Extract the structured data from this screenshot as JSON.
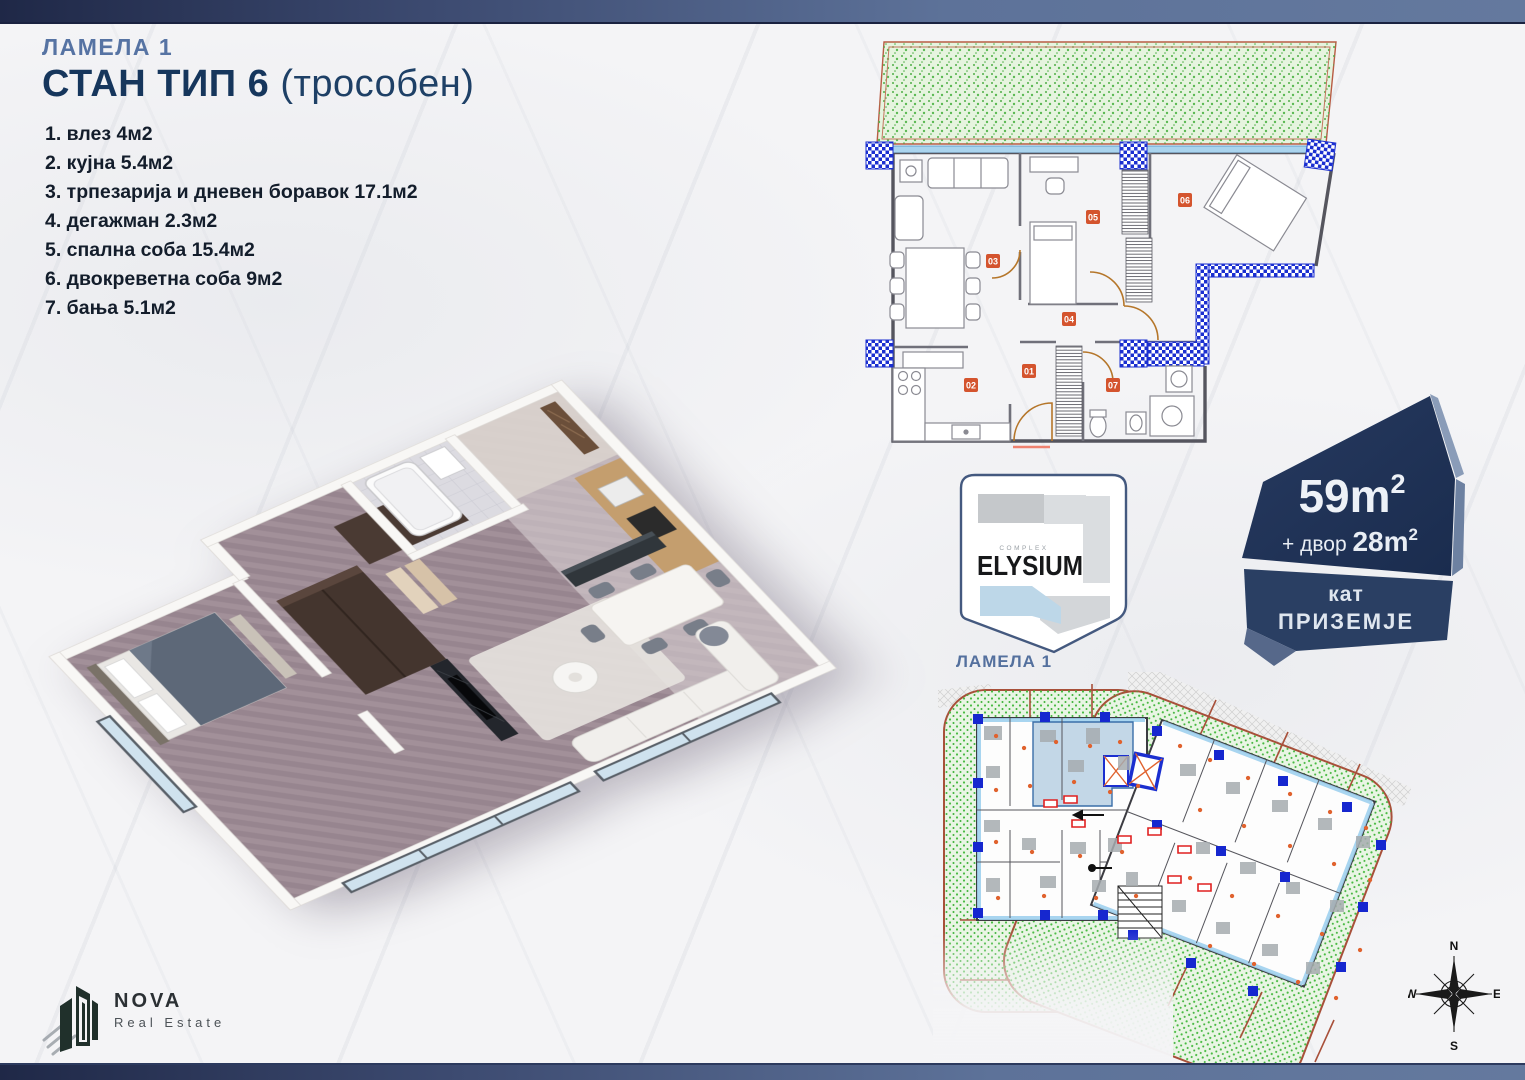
{
  "title": {
    "lamela": "ЛАМЕЛА 1",
    "main": "СТАН ТИП 6",
    "sub": "(трособен)"
  },
  "rooms": [
    "1. влез 4м2",
    "2. кујна 5.4м2",
    "3. трпезарија и дневен боравок 17.1м2",
    "4. дегажман 2.3м2",
    "5. спална соба 15.4м2",
    "6. двокреветна соба 9м2",
    "7. бања 5.1м2"
  ],
  "plan2d": {
    "labels": [
      "01",
      "02",
      "03",
      "04",
      "05",
      "06",
      "07"
    ]
  },
  "elysium": {
    "complex_label": "COMPLEX",
    "brand": "ELYSIUM",
    "lamela_label": "ЛАМЕЛА 1"
  },
  "badge": {
    "area_value": "59m",
    "area_sup": "2",
    "yard_prefix": "+ двор ",
    "yard_value": "28m",
    "yard_sup": "2",
    "floor_label": "кат",
    "floor_value": "ПРИЗЕМЈЕ"
  },
  "compass": {
    "north": "N",
    "east": "E",
    "south": "S",
    "west": "W"
  },
  "nova": {
    "brand": "NOVA",
    "subtitle": "Real Estate"
  },
  "colors": {
    "accent_navy": "#16365c",
    "steel_blue": "#5673a3",
    "bar_dark": "#1f2847",
    "bar_light": "#64799e",
    "yard_green": "#e6f4df",
    "yard_dot_green": "#4fae47",
    "plan_red_border": "#b85c44",
    "column_blue": "#1b2fd0",
    "window_blue": "#aad4ee",
    "room_label_orange": "#d4542e",
    "door_arc_brown": "#b5762a",
    "badge_dark": "#203255",
    "badge_mid": "#2a3f63",
    "highlight_unit_blue": "#c3d7e7"
  }
}
